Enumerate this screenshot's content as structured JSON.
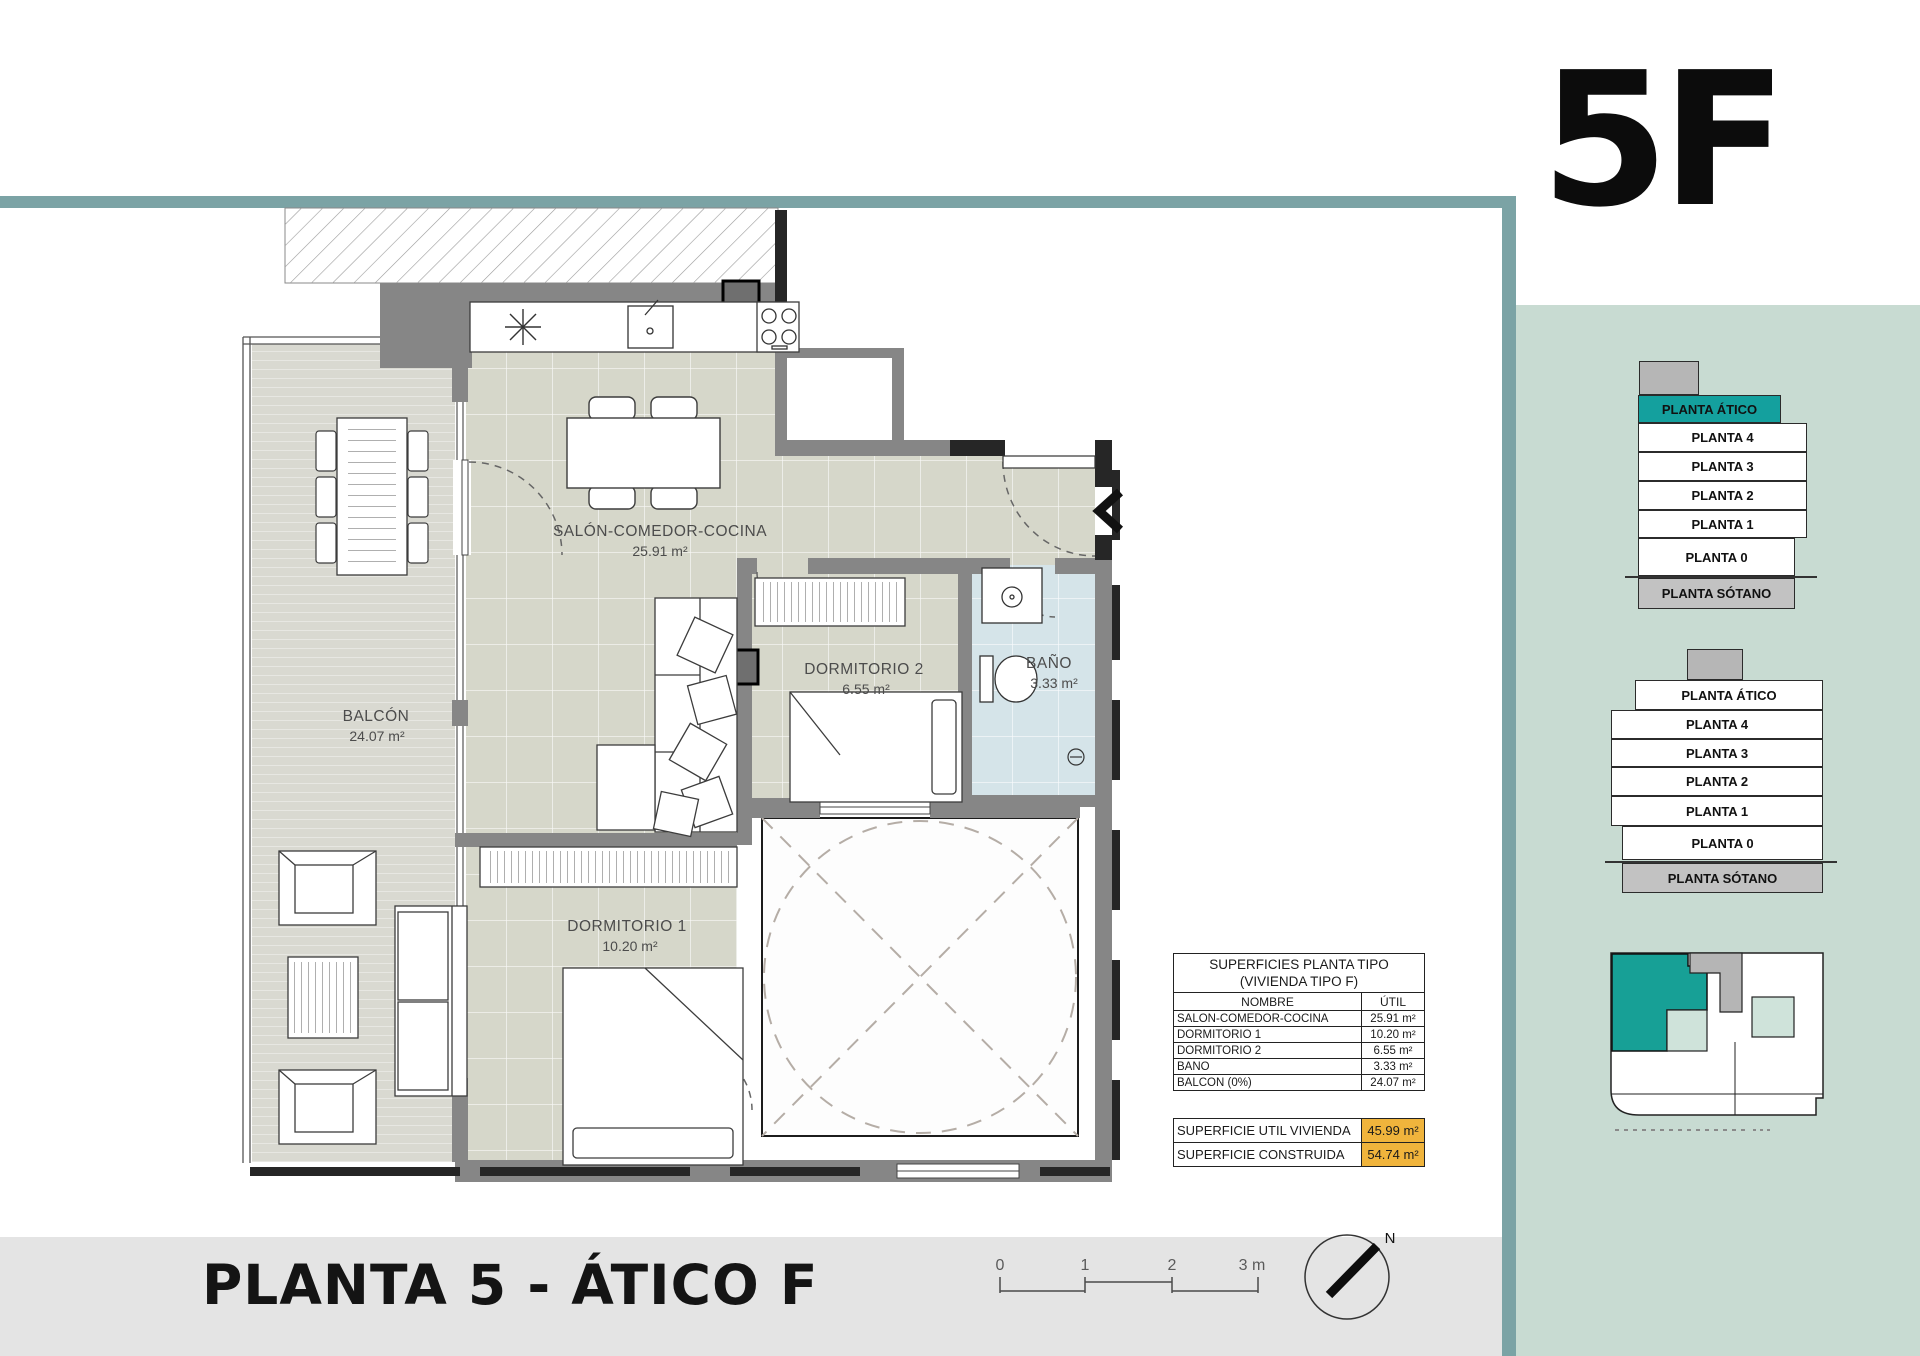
{
  "header": {
    "unit_label": "5F"
  },
  "plan_labels": {
    "salon": {
      "name": "SALÓN-COMEDOR-COCINA",
      "area": "25.91 m²"
    },
    "balcon": {
      "name": "BALCÓN",
      "area": "24.07 m²"
    },
    "dorm2": {
      "name": "DORMITORIO 2",
      "area": "6.55 m²"
    },
    "bano": {
      "name": "BAÑO",
      "area": "3.33 m²"
    },
    "dorm1": {
      "name": "DORMITORIO 1",
      "area": "10.20 m²"
    }
  },
  "surfaces_table": {
    "title_line1": "SUPERFICIES PLANTA TIPO",
    "title_line2": "(VIVIENDA TIPO F)",
    "columns": {
      "name": "NOMBRE",
      "util": "ÚTIL"
    },
    "rows": [
      {
        "name": "SALÓN-COMEDOR-COCINA",
        "util": "25.91 m²"
      },
      {
        "name": "DORMITORIO 1",
        "util": "10.20 m²"
      },
      {
        "name": "DORMITORIO 2",
        "util": "6.55 m²"
      },
      {
        "name": "BAÑO",
        "util": "3.33 m²"
      },
      {
        "name": "BALCÓN (0%)",
        "util": "24.07 m²"
      }
    ],
    "totals": [
      {
        "label": "SUPERFICIE UTIL VIVIENDA",
        "value": "45.99 m²"
      },
      {
        "label": "SUPERFICIE CONSTRUIDA",
        "value": "54.74 m²"
      }
    ]
  },
  "stacks": {
    "stack1": {
      "floors": [
        "PLANTA ÁTICO",
        "PLANTA 4",
        "PLANTA 3",
        "PLANTA 2",
        "PLANTA 1",
        "PLANTA 0",
        "PLANTA SÓTANO"
      ],
      "highlighted": "PLANTA ÁTICO"
    },
    "stack2": {
      "floors": [
        "PLANTA ÁTICO",
        "PLANTA 4",
        "PLANTA 3",
        "PLANTA 2",
        "PLANTA 1",
        "PLANTA 0",
        "PLANTA SÓTANO"
      ]
    }
  },
  "footer": {
    "title": "PLANTA 5 - ÁTICO F",
    "scale_ticks": [
      "0",
      "1",
      "2",
      "3 m"
    ],
    "compass_label": "N"
  },
  "colors": {
    "accent_teal": "#14a09e",
    "border_teal": "#7ba3a5",
    "sidebar_green": "#c8dbd2",
    "highlight_orange": "#f0b43c",
    "wall_gray": "#868686",
    "floor_beige": "#d6d7ca",
    "bath_blue": "#d5e4e9"
  }
}
